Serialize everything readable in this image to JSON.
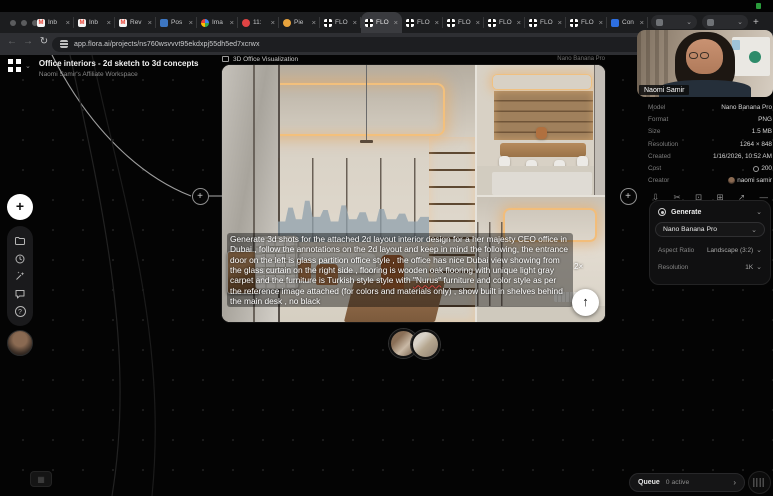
{
  "menubar": {
    "indicator_color": "#35c24a"
  },
  "browser": {
    "tabs": [
      {
        "label": "Inb",
        "icon": "gmail",
        "active": false
      },
      {
        "label": "Inb",
        "icon": "gmail",
        "active": false
      },
      {
        "label": "Rev",
        "icon": "gmail",
        "active": false
      },
      {
        "label": "Pos",
        "icon": "blue",
        "active": false
      },
      {
        "label": "Ima",
        "icon": "google",
        "active": false
      },
      {
        "label": "11:",
        "icon": "red",
        "active": false
      },
      {
        "label": "Pie",
        "icon": "orange",
        "active": false
      },
      {
        "label": "FLO",
        "icon": "flora",
        "active": false
      },
      {
        "label": "FLO",
        "icon": "flora",
        "active": true
      },
      {
        "label": "FLO",
        "icon": "flora",
        "active": false
      },
      {
        "label": "FLO",
        "icon": "flora",
        "active": false
      },
      {
        "label": "FLO",
        "icon": "flora",
        "active": false
      },
      {
        "label": "FLO",
        "icon": "flora",
        "active": false
      },
      {
        "label": "FLO",
        "icon": "flora",
        "active": false
      },
      {
        "label": "Con",
        "icon": "blue2",
        "active": false
      }
    ],
    "nav": {
      "back": "←",
      "forward": "→",
      "reload": "↻",
      "new_tab": "+",
      "chip_chevron": "⌄"
    },
    "url": "app.flora.ai/projects/ns760wsvvvt95ekdxpj55dh5ed7xcrwx"
  },
  "header": {
    "title": "Office interiors - 2d sketch to 3d concepts",
    "workspace": "Naomi Samir's Affiliate Workspace",
    "logo_chevron": "⌄"
  },
  "side_toolbar": {
    "add_label": "+",
    "icons": [
      "add",
      "folder",
      "history",
      "wand-sparkle",
      "chat",
      "help",
      "avatar"
    ],
    "help_glyph": "?"
  },
  "node": {
    "type_label": "3D Office Visualization",
    "model_badge": "Nano Banana Pro",
    "prompt": "Generate 3d shots for the attached 2d layout interior design for a her majesty CEO office in Dubai , follow the annotations on the 2d layout and keep in mind the following, the entrance door on the left is glass partition office style , the office has nice Dubai view showing from the glass curtain on the right side , flooring is wooden oak flooring with unique light gray carpet  and the furniture is Turkish style style with \"Nurus\" furniture and color style as per the reference image attached (for colors and materials only) , show built in shelves behind the main desk , no black",
    "highlight_word": "\"Nurus\"",
    "zoom_badge": "2×",
    "submit_icon": "↑",
    "connector_glyph": "+"
  },
  "webcam": {
    "name": "Naomi Samir"
  },
  "inspector": {
    "rows": [
      {
        "label": "Model",
        "value": "Nano Banana Pro"
      },
      {
        "label": "Format",
        "value": "PNG"
      },
      {
        "label": "Size",
        "value": "1.5 MB"
      },
      {
        "label": "Resolution",
        "value": "1264 × 848"
      },
      {
        "label": "Created",
        "value": "1/16/2026, 10:52 AM"
      },
      {
        "label": "Cost",
        "value": "200",
        "icon": "coin"
      },
      {
        "label": "Creator",
        "value": "naomi samir",
        "icon": "avatar"
      }
    ],
    "actions": [
      {
        "name": "download-icon",
        "glyph": "⇩"
      },
      {
        "name": "remix-icon",
        "glyph": "✂"
      },
      {
        "name": "crop-icon",
        "glyph": "⊡"
      },
      {
        "name": "duplicate-icon",
        "glyph": "⊞"
      },
      {
        "name": "expand-icon",
        "glyph": "↗"
      },
      {
        "name": "more-icon",
        "glyph": "—"
      }
    ]
  },
  "generate_panel": {
    "title": "Generate",
    "chevron": "⌄",
    "model": "Nano Banana Pro",
    "aspect_ratio_label": "Aspect Ratio",
    "aspect_ratio_value": "Landscape (3:2)",
    "resolution_label": "Resolution",
    "resolution_value": "1K"
  },
  "queue": {
    "label": "Queue",
    "status": "0 active",
    "chevron": "›"
  }
}
